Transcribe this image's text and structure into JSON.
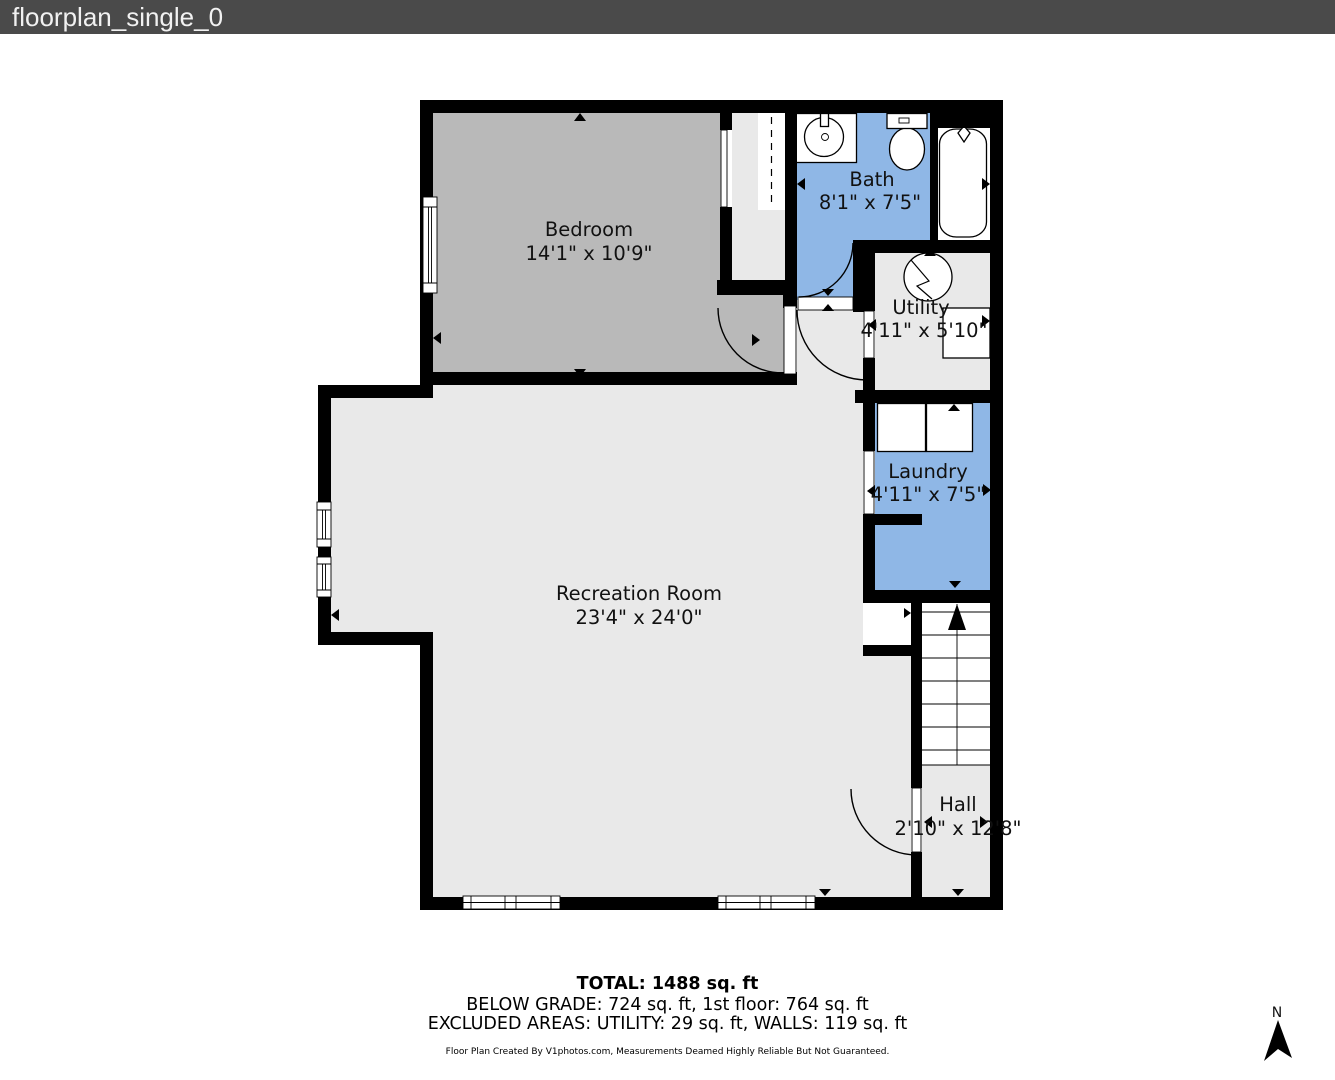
{
  "window": {
    "title": "floorplan_single_0"
  },
  "rooms": [
    {
      "id": "bedroom",
      "name": "Bedroom",
      "dims": "14'1\" x 10'9\""
    },
    {
      "id": "bath",
      "name": "Bath",
      "dims": "8'1\" x 7'5\""
    },
    {
      "id": "utility",
      "name": "Utility",
      "dims": "4'11\" x 5'10\""
    },
    {
      "id": "laundry",
      "name": "Laundry",
      "dims": "4'11\" x 7'5\""
    },
    {
      "id": "recreation",
      "name": "Recreation Room",
      "dims": "23'4\" x 24'0\""
    },
    {
      "id": "hall",
      "name": "Hall",
      "dims": "2'10\" x 12'8\""
    }
  ],
  "summary": {
    "total": "TOTAL: 1488 sq. ft",
    "below_grade": "BELOW GRADE: 724 sq. ft, 1st floor: 764 sq. ft",
    "excluded": "EXCLUDED AREAS: UTILITY: 29 sq. ft, WALLS: 119 sq. ft",
    "disclaimer": "Floor Plan Created By V1photos.com, Measurements Deamed Highly Reliable But Not Guaranteed."
  },
  "compass": {
    "north_label": "N"
  },
  "colors": {
    "wall": "#000000",
    "title_bar": "#4a4a4a",
    "title_text": "#f1f1f1",
    "bedroom_fill": "#b9b9b9",
    "wet_fill": "#8fb7e6",
    "room_fill": "#e9e9e9",
    "label_text": "#111111"
  }
}
